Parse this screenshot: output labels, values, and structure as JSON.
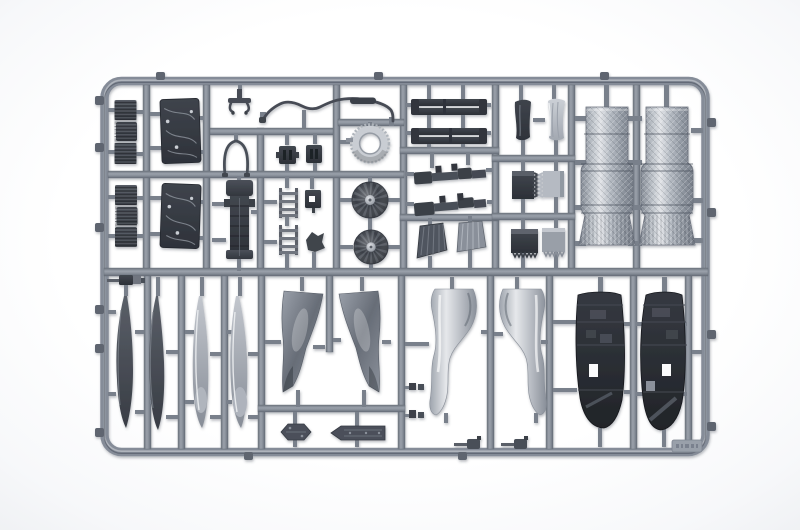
{
  "image": {
    "type": "photograph",
    "description": "Grey injection-moulded plastic sprue (parts tree) of a scale model aircraft kit on a white background, holding ribbed intake blocks, engraved fuselage panels, a turbine ring and two compressor fans, slender pylon strips, sawtooth heat-shield panels, two large lattice-textured exhaust nozzle cylinders, four long stabilator blades, curved wing panels, two S-shaped intake duct halves, two dark detailed bay panels and assorted small parts."
  },
  "colors": {
    "background": "#fbfcfd",
    "runner_grey": "#8b919d",
    "runner_shadow": "#6e7480",
    "part_dark": "#383d45",
    "part_mid": "#6f757f",
    "part_light": "#c6cad1",
    "highlight": "#e8eaed"
  },
  "stamp": {
    "label": "embossed mould code (illegible)"
  },
  "parts_manifest": [
    {
      "name": "ribbed-intake-block",
      "count": 2
    },
    {
      "name": "engraved-fuselage-panel",
      "count": 2
    },
    {
      "name": "tow-bar",
      "count": 1
    },
    {
      "name": "wishbone-frame",
      "count": 1
    },
    {
      "name": "fuselage-spine",
      "count": 1
    },
    {
      "name": "boarding-ladder",
      "count": 2
    },
    {
      "name": "wavy-pipe",
      "count": 1
    },
    {
      "name": "afterburner-ring",
      "count": 1
    },
    {
      "name": "turbine-fan",
      "count": 2
    },
    {
      "name": "pylon-strip",
      "count": 4
    },
    {
      "name": "linkage-assembly",
      "count": 2
    },
    {
      "name": "feather-nozzle-segment",
      "count": 2
    },
    {
      "name": "intake-lip",
      "count": 2
    },
    {
      "name": "sawtooth-panel",
      "count": 4
    },
    {
      "name": "exhaust-nozzle-cylinder",
      "count": 2
    },
    {
      "name": "stabilator-blade",
      "count": 4
    },
    {
      "name": "curved-wing-panel",
      "count": 2
    },
    {
      "name": "hexagonal-plate",
      "count": 1
    },
    {
      "name": "arrow-plate",
      "count": 1
    },
    {
      "name": "s-intake-duct",
      "count": 2
    },
    {
      "name": "detailed-bay-panel",
      "count": 2
    },
    {
      "name": "small-detail-part",
      "count": 8
    }
  ]
}
